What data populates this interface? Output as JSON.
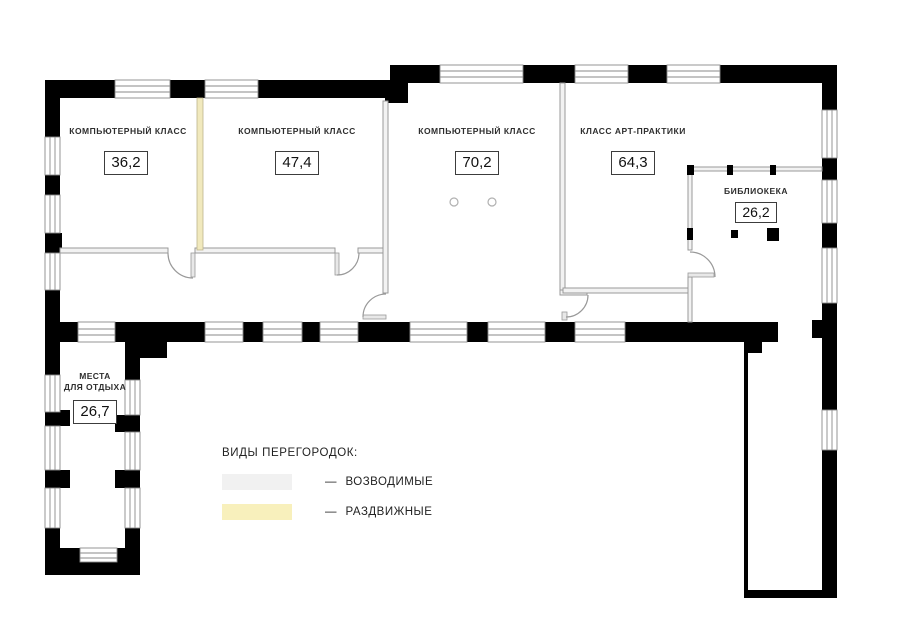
{
  "plan": {
    "rooms": [
      {
        "name": "КОМПЬЮТЕРНЫЙ КЛАСС",
        "area": "36,2"
      },
      {
        "name": "КОМПЬЮТЕРНЫЙ КЛАСС",
        "area": "47,4"
      },
      {
        "name": "КОМПЬЮТЕРНЫЙ КЛАСС",
        "area": "70,2"
      },
      {
        "name": "КЛАСС АРТ-ПРАКТИКИ",
        "area": "64,3"
      },
      {
        "name": "БИБЛИОКЕКА",
        "area": "26,2"
      },
      {
        "name": "МЕСТА ДЛЯ ОТДЫХА",
        "name_line1": "МЕСТА",
        "name_line2": "ДЛЯ ОТДЫХА",
        "area": "26,7"
      }
    ],
    "legend": {
      "title": "ВИДЫ ПЕРЕГОРОДОК:",
      "items": [
        {
          "dash": "—",
          "label": "ВОЗВОДИМЫЕ",
          "swatch_color": "#f1f1f1"
        },
        {
          "dash": "—",
          "label": "РАЗДВИЖНЫЕ",
          "swatch_color": "#f8f0bc"
        }
      ]
    },
    "colors": {
      "wall": "#000000",
      "erected_partition_fill": "#f2f2f2",
      "partition_line": "#999999",
      "sliding_partition_fill": "#f1e9bd",
      "window_line": "#8a8a8a"
    }
  }
}
